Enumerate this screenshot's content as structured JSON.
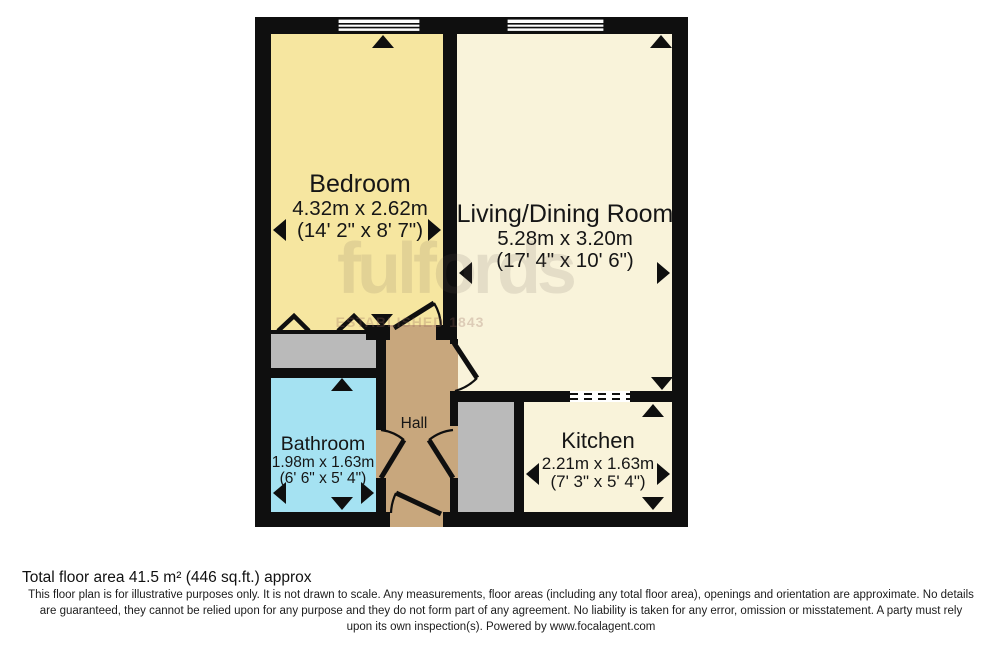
{
  "plan": {
    "rooms": {
      "bedroom": {
        "name": "Bedroom",
        "metric": "4.32m x 2.62m",
        "imperial": "(14' 2\" x 8' 7\")"
      },
      "living": {
        "name": "Living/Dining Room",
        "metric": "5.28m x 3.20m",
        "imperial": "(17' 4\" x 10' 6\")"
      },
      "bathroom": {
        "name": "Bathroom",
        "metric": "1.98m x 1.63m",
        "imperial": "(6' 6\" x 5' 4\")"
      },
      "kitchen": {
        "name": "Kitchen",
        "metric": "2.21m x 1.63m",
        "imperial": "(7' 3\" x 5' 4\")"
      },
      "hall": {
        "name": "Hall"
      }
    },
    "colors": {
      "bedroom": "#f6e6a0",
      "living": "#f9f3da",
      "kitchen": "#f9f3da",
      "bathroom": "#a5e2f2",
      "hall": "#c8a77d",
      "storage": "#bababa",
      "wall": "#0f0f0f"
    }
  },
  "watermark": {
    "brand": "fulfords",
    "tagline": "ESTABLISHED 1843"
  },
  "footer": {
    "total_area": "Total floor area 41.5 m² (446 sq.ft.) approx",
    "disclaimer": "This floor plan is for illustrative purposes only. It is not drawn to scale. Any measurements, floor areas (including any total floor area), openings and orientation are approximate. No details are guaranteed, they cannot be relied upon for any purpose and they do not form part of any agreement. No liability is taken for any error, omission or misstatement. A party must rely upon its own inspection(s). Powered by www.focalagent.com"
  }
}
